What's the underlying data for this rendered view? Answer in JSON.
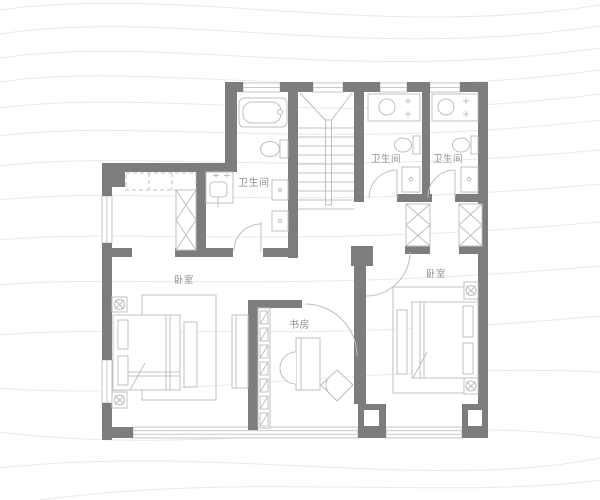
{
  "meta": {
    "view": "residential-floor-plan",
    "floor_outline": "irregular-l-shape"
  },
  "colors": {
    "background": "#ffffff",
    "wall": "#7c7d7f",
    "window_line": "#c5c8ca",
    "furniture_line": "#bcc0c3",
    "label_text": "#8d9298",
    "watermark": "#e9e9e9"
  },
  "rooms": {
    "bathroom_main": {
      "label": "卫生间"
    },
    "bathroom_mid": {
      "label": "卫生间"
    },
    "bathroom_right": {
      "label": "卫生间"
    },
    "bedroom_left": {
      "label": "卧室"
    },
    "bedroom_right": {
      "label": "卧室"
    },
    "study": {
      "label": "书房"
    }
  },
  "fixtures": [
    "bathtub-icon",
    "toilet-icon",
    "sink-icon",
    "shower-basin-icon",
    "washer-icon",
    "stairs",
    "bed",
    "pillow",
    "nightstand-flower-icon",
    "rug",
    "bench",
    "wardrobe-x-icon",
    "closet-shelves",
    "bookshelf",
    "desk",
    "desk-chair-icon",
    "lounge-chair-icon",
    "dresser",
    "door-arc",
    "window-band"
  ]
}
